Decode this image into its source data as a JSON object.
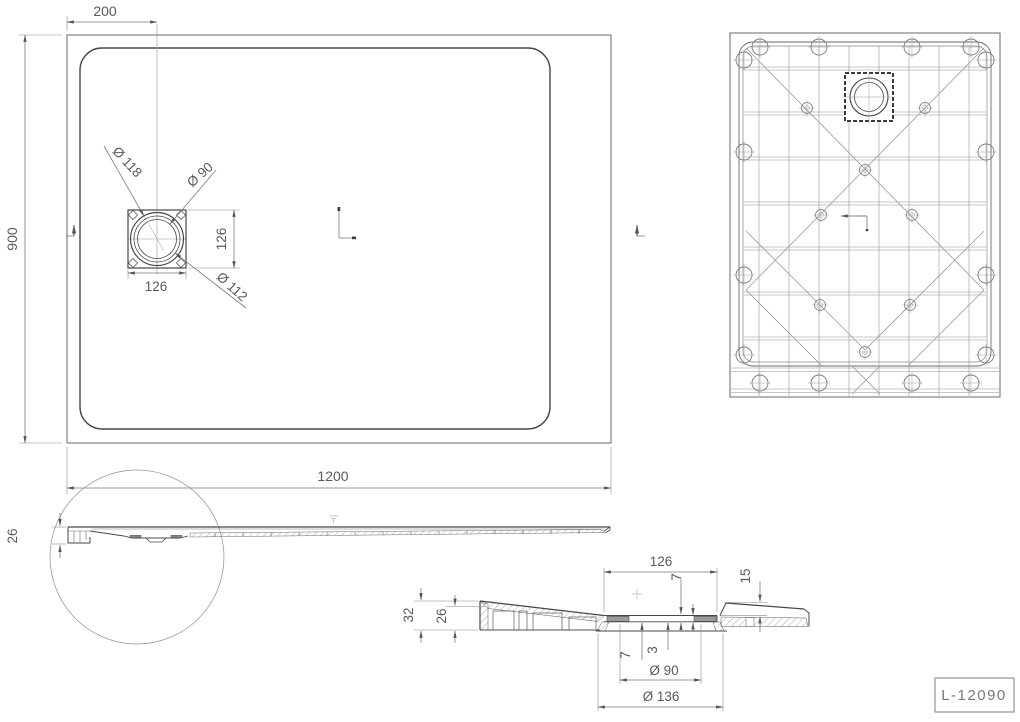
{
  "drawing": {
    "part_number": "L-12090",
    "plan_view": {
      "drain_offset_dim": "200",
      "height_dim": "900",
      "width_dim": "1200",
      "drain_width_dim": "126",
      "drain_height_dim": "126",
      "drain_outer_dia": "Ø 118",
      "drain_inner_dia": "Ø 90",
      "drain_flange_dia": "Ø 112"
    },
    "side_view": {
      "height_dim": "26"
    },
    "section_view": {
      "recess_width_dim": "126",
      "recess_depth_dim": "7",
      "edge_drop_dim": "15",
      "total_height_dim": "32",
      "inner_height_dim": "26",
      "spout_depth_dim": "7",
      "pad_thickness_dim": "3",
      "hole_dia": "Ø 90",
      "flange_dia": "Ø 136"
    }
  }
}
